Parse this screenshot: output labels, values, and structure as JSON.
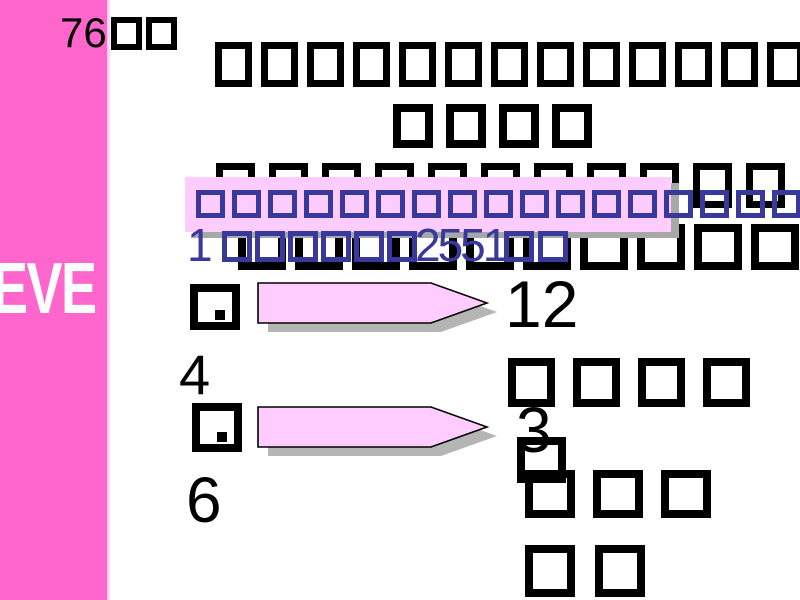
{
  "colors": {
    "bar-pink": "#ff66cc",
    "bar-edge": "#ffd6f2",
    "light-pink": "#ffccff",
    "tofu-blue": "#39399b",
    "shadow-gray": "#a8a8a8"
  },
  "sidebar": {
    "label": "EVE"
  },
  "title": {
    "glyph": "missing-glyph-box",
    "lines": [
      {
        "boxes": 13
      },
      {
        "boxes": 4
      },
      {
        "boxes": 11
      },
      {
        "boxes": 10
      }
    ]
  },
  "highlight": {
    "boxes": 17
  },
  "date_line": {
    "day": "1",
    "month_boxes": 6,
    "year": "2551",
    "suffix_boxes": 2
  },
  "answers": {
    "item1_punct": ".",
    "item1_value": "4",
    "item2_punct": ".",
    "item2_value": "6"
  },
  "arrows": [
    {
      "label": "",
      "label_boxes": 0
    },
    {
      "label": "76",
      "label_boxes": 2
    }
  ],
  "result": {
    "line1": "12",
    "line2_boxes": 4,
    "line3": "3",
    "line3_boxes": 1,
    "line4_boxes": 3,
    "line5_boxes": 2
  }
}
